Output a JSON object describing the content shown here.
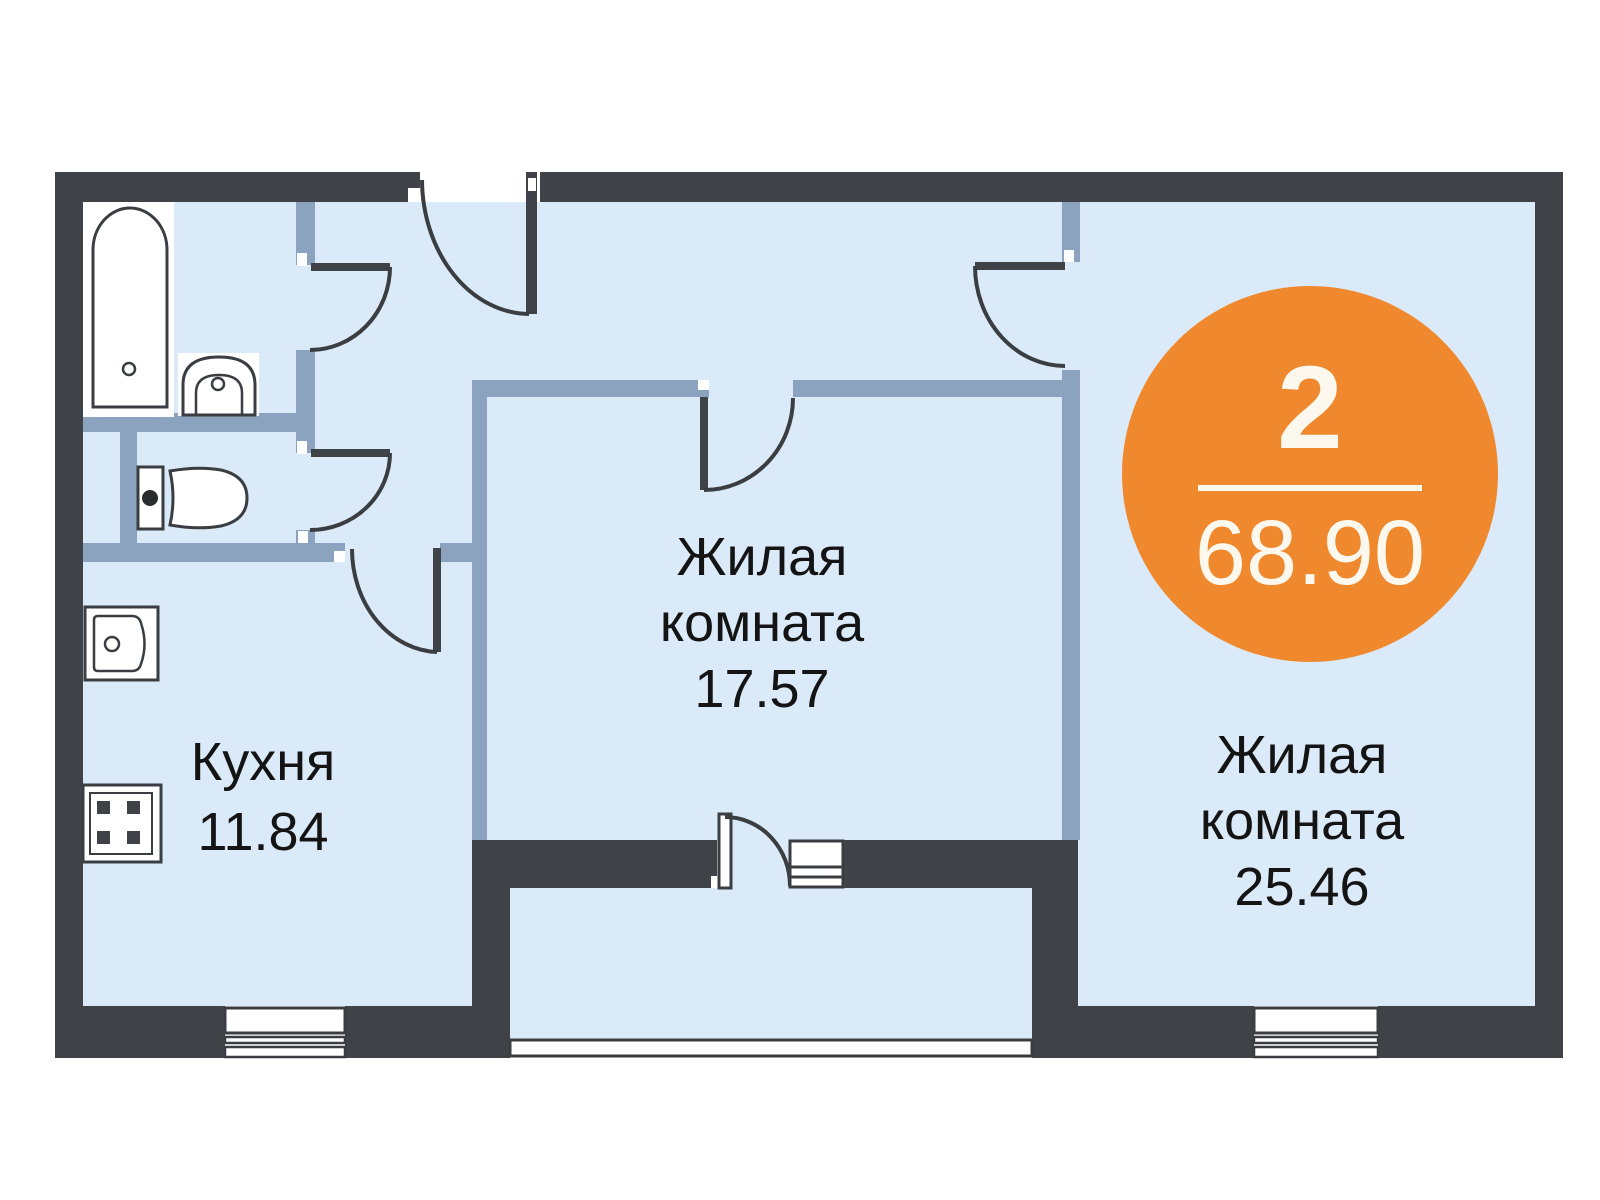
{
  "floor_plan": {
    "badge": {
      "room_count": "2",
      "total_area": "68.90"
    },
    "rooms": {
      "living_room_1": {
        "line1": "Жилая",
        "line2": "комната",
        "area": "17.57"
      },
      "living_room_2": {
        "line1": "Жилая",
        "line2": "комната",
        "area": "25.46"
      },
      "kitchen": {
        "name": "Кухня",
        "area": "11.84"
      }
    },
    "fixtures": [
      "bathtub-icon",
      "bathroom-sink-icon",
      "toilet-icon",
      "kitchen-sink-icon",
      "stove-icon"
    ],
    "features": [
      "entrance-door",
      "bathroom-door",
      "wc-door",
      "kitchen-door",
      "living-room-1-door",
      "living-room-2-door",
      "balcony-door",
      "balcony-window",
      "kitchen-window",
      "living-room-2-window",
      "balcony-glazing"
    ],
    "colors": {
      "floor": "#DBEAF8",
      "wall_outer": "#3F4246",
      "wall_partition": "#8CA3BF",
      "accent_orange": "#F0882D",
      "badge_text": "#FCF8EE"
    }
  }
}
